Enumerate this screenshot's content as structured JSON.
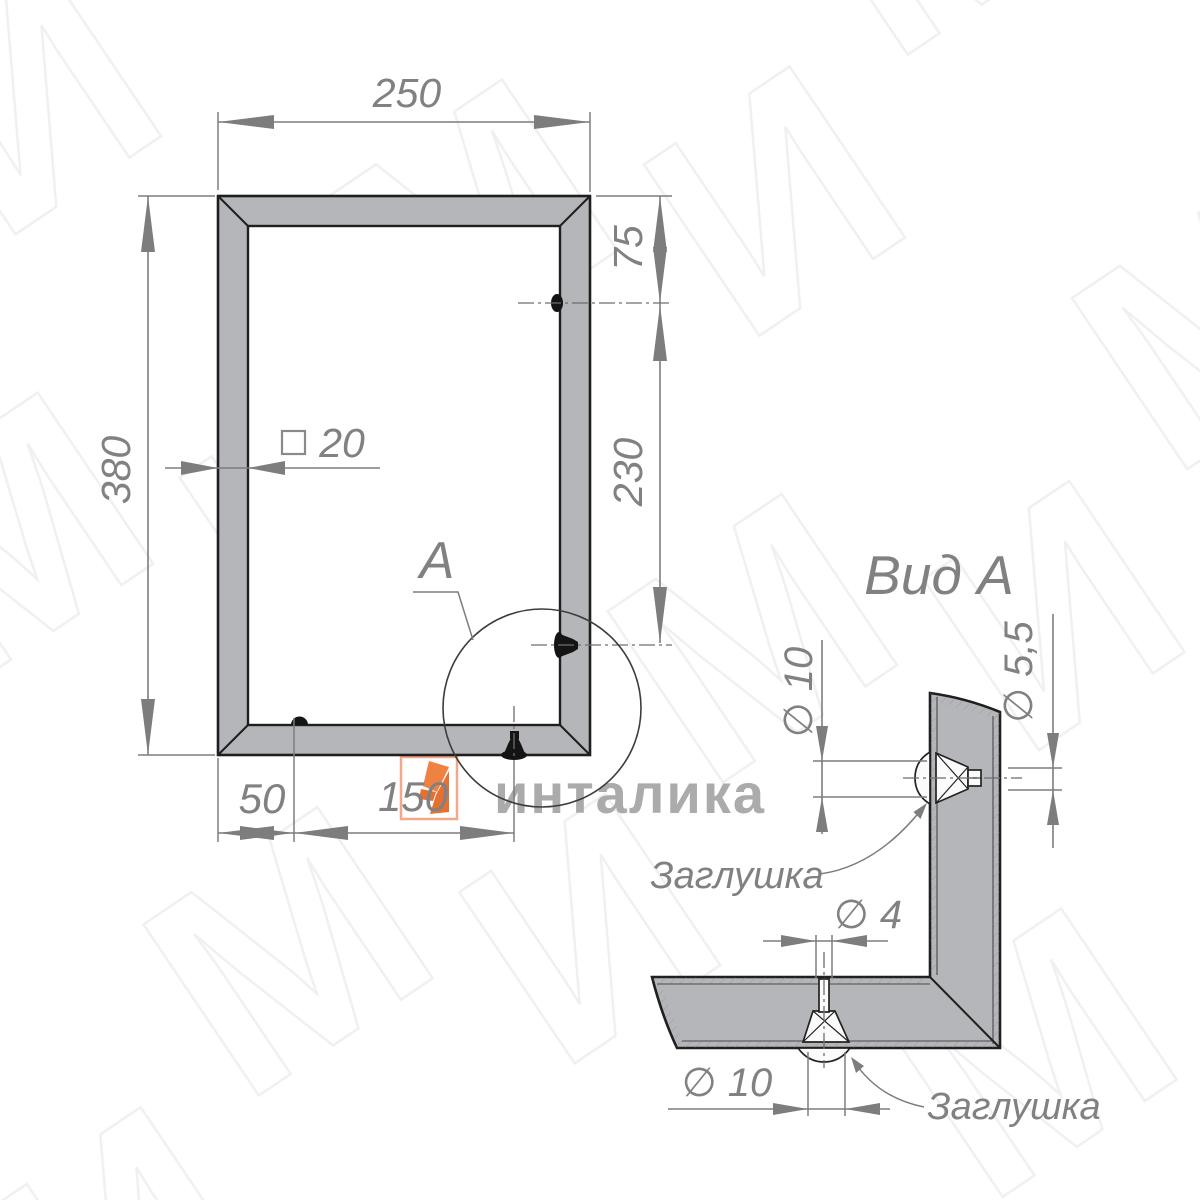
{
  "drawing": {
    "type": "technical-drawing",
    "language": "ru"
  },
  "colors": {
    "outline_black": "#1f1f1f",
    "profile_gray_fill": "#b4b6b9",
    "dimension_gray": "#7d7d7d",
    "text_gray": "#818181",
    "watermark_gray": "#ababab",
    "watermark_pattern": "#f0f0f3",
    "brand_orange": "#e8702f",
    "brand_orange_light": "#f3a988"
  },
  "main_view": {
    "dim_width": "250",
    "dim_height": "380",
    "dim_top_hole_offset": "75",
    "dim_hole_spacing": "230",
    "dim_profile_square": "20",
    "dim_bottom_left": "50",
    "dim_bottom_center": "150",
    "detail_label": "А"
  },
  "view_a": {
    "title": "Вид А",
    "dim_plug_side": "∅ 10",
    "dim_hole_side": "∅ 5,5",
    "dim_stem_hole": "∅ 4",
    "dim_plug_bottom": "∅ 10",
    "plug_label_side": "Заглушка",
    "plug_label_bottom": "Заглушка"
  },
  "watermark": {
    "brand_text": "инталика",
    "logo_icon": "orange-i-logo"
  }
}
